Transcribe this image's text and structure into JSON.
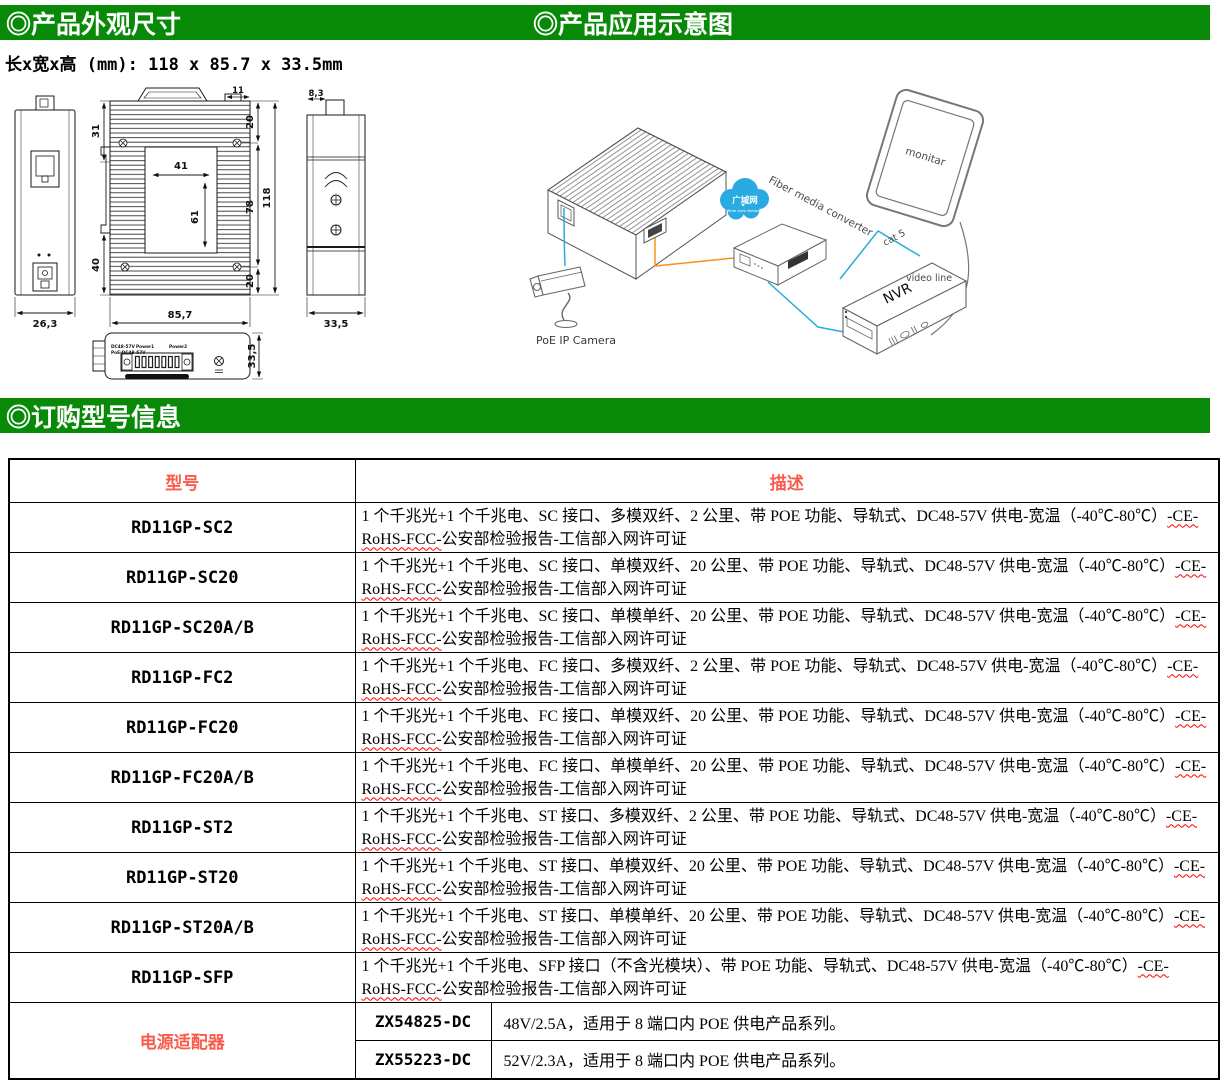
{
  "sections": {
    "appearance_title": "◎产品外观尺寸",
    "application_title": "◎产品应用示意图",
    "order_title": "◎订购型号信息",
    "dimensions_line": "长x宽x高 (mm): 118 x 85.7 x 33.5mm"
  },
  "colors": {
    "green": "#088A08",
    "red": "#FA5B4A",
    "blue": "#29ABE2",
    "orange": "#F7931E"
  },
  "drawing": {
    "front": {
      "width": "26,3"
    },
    "rear": {
      "top_offset": "31",
      "bottom_offset": "40",
      "plate_width": "41",
      "plate_height": "61",
      "tab_width": "11",
      "right_top": "20",
      "right_middle": "78",
      "height_total": "118",
      "right_bottom": "20",
      "width_total": "85,7"
    },
    "side": {
      "tab": "8,3",
      "width": "33,5"
    },
    "top": {
      "depth": "33,5",
      "dc_label": "DC48-57V",
      "poe_label": "PoE:DC48-57V",
      "power1": "Power1",
      "power2": "Power2"
    }
  },
  "diagram": {
    "camera_label": "PoE IP Camera",
    "cloud_label": "广域网",
    "cloud_sub": "Wide Area Network",
    "converter_label": "Fiber media converter",
    "monitor_label": "monitar",
    "nvr_label": "NVR",
    "cat5_label": "cat 5",
    "video_label": "video line"
  },
  "table": {
    "col_model": "型号",
    "col_desc": "描述",
    "rows": [
      {
        "model": "RD11GP-SC2",
        "desc": "1 个千兆光+1 个千兆电、SC 接口、多模双纤、2 公里、带 POE 功能、导轨式、DC48-57V 供电-宽温（-40℃-80℃）",
        "cert": "-CE-RoHS-FCC-",
        "tail": "公安部检验报告-工信部入网许可证"
      },
      {
        "model": "RD11GP-SC20",
        "desc": "1 个千兆光+1 个千兆电、SC 接口、单模双纤、20 公里、带 POE 功能、导轨式、DC48-57V 供电-宽温（-40℃-80℃）",
        "cert": "-CE-RoHS-FCC-",
        "tail": "公安部检验报告-工信部入网许可证"
      },
      {
        "model": "RD11GP-SC20A/B",
        "desc": "1 个千兆光+1 个千兆电、SC 接口、单模单纤、20 公里、带 POE 功能、导轨式、DC48-57V 供电-宽温（-40℃-80℃）",
        "cert": "-CE-RoHS-FCC-",
        "tail": "公安部检验报告-工信部入网许可证"
      },
      {
        "model": "RD11GP-FC2",
        "desc": "1 个千兆光+1 个千兆电、FC 接口、多模双纤、2 公里、带 POE 功能、导轨式、DC48-57V 供电-宽温（-40℃-80℃）",
        "cert": "-CE-RoHS-FCC-",
        "tail": "公安部检验报告-工信部入网许可证"
      },
      {
        "model": "RD11GP-FC20",
        "desc": "1 个千兆光+1 个千兆电、FC 接口、单模双纤、20 公里、带 POE 功能、导轨式、DC48-57V 供电-宽温（-40℃-80℃）",
        "cert": "-CE-RoHS-FCC-",
        "tail": "公安部检验报告-工信部入网许可证"
      },
      {
        "model": "RD11GP-FC20A/B",
        "desc": "1 个千兆光+1 个千兆电、FC 接口、单模单纤、20 公里、带 POE 功能、导轨式、DC48-57V 供电-宽温（-40℃-80℃）",
        "cert": "-CE-RoHS-FCC-",
        "tail": "公安部检验报告-工信部入网许可证"
      },
      {
        "model": "RD11GP-ST2",
        "desc": "1 个千兆光+1 个千兆电、ST 接口、多模双纤、2 公里、带 POE 功能、导轨式、DC48-57V 供电-宽温（-40℃-80℃）",
        "cert": "-CE-RoHS-FCC-",
        "tail": "公安部检验报告-工信部入网许可证"
      },
      {
        "model": "RD11GP-ST20",
        "desc": "1 个千兆光+1 个千兆电、ST 接口、单模双纤、20 公里、带 POE 功能、导轨式、DC48-57V 供电-宽温（-40℃-80℃）",
        "cert": "-CE-RoHS-FCC-",
        "tail": "公安部检验报告-工信部入网许可证"
      },
      {
        "model": "RD11GP-ST20A/B",
        "desc": "1 个千兆光+1 个千兆电、ST 接口、单模单纤、20 公里、带 POE 功能、导轨式、DC48-57V 供电-宽温（-40℃-80℃）",
        "cert": "-CE-RoHS-FCC-",
        "tail": "公安部检验报告-工信部入网许可证"
      },
      {
        "model": "RD11GP-SFP",
        "desc": "1 个千兆光+1 个千兆电、SFP 接口（不含光模块）、带 POE 功能、导轨式、DC48-57V 供电-宽温（-40℃-80℃）",
        "cert": "-CE-RoHS-FCC-",
        "tail": "公安部检验报告-工信部入网许可证"
      }
    ],
    "adapter": {
      "label": "电源适配器",
      "items": [
        {
          "model": "ZX54825-DC",
          "desc": "48V/2.5A，适用于 8 端口内 POE 供电产品系列。"
        },
        {
          "model": "ZX55223-DC",
          "desc": "52V/2.3A，适用于 8 端口内 POE 供电产品系列。"
        }
      ]
    }
  }
}
